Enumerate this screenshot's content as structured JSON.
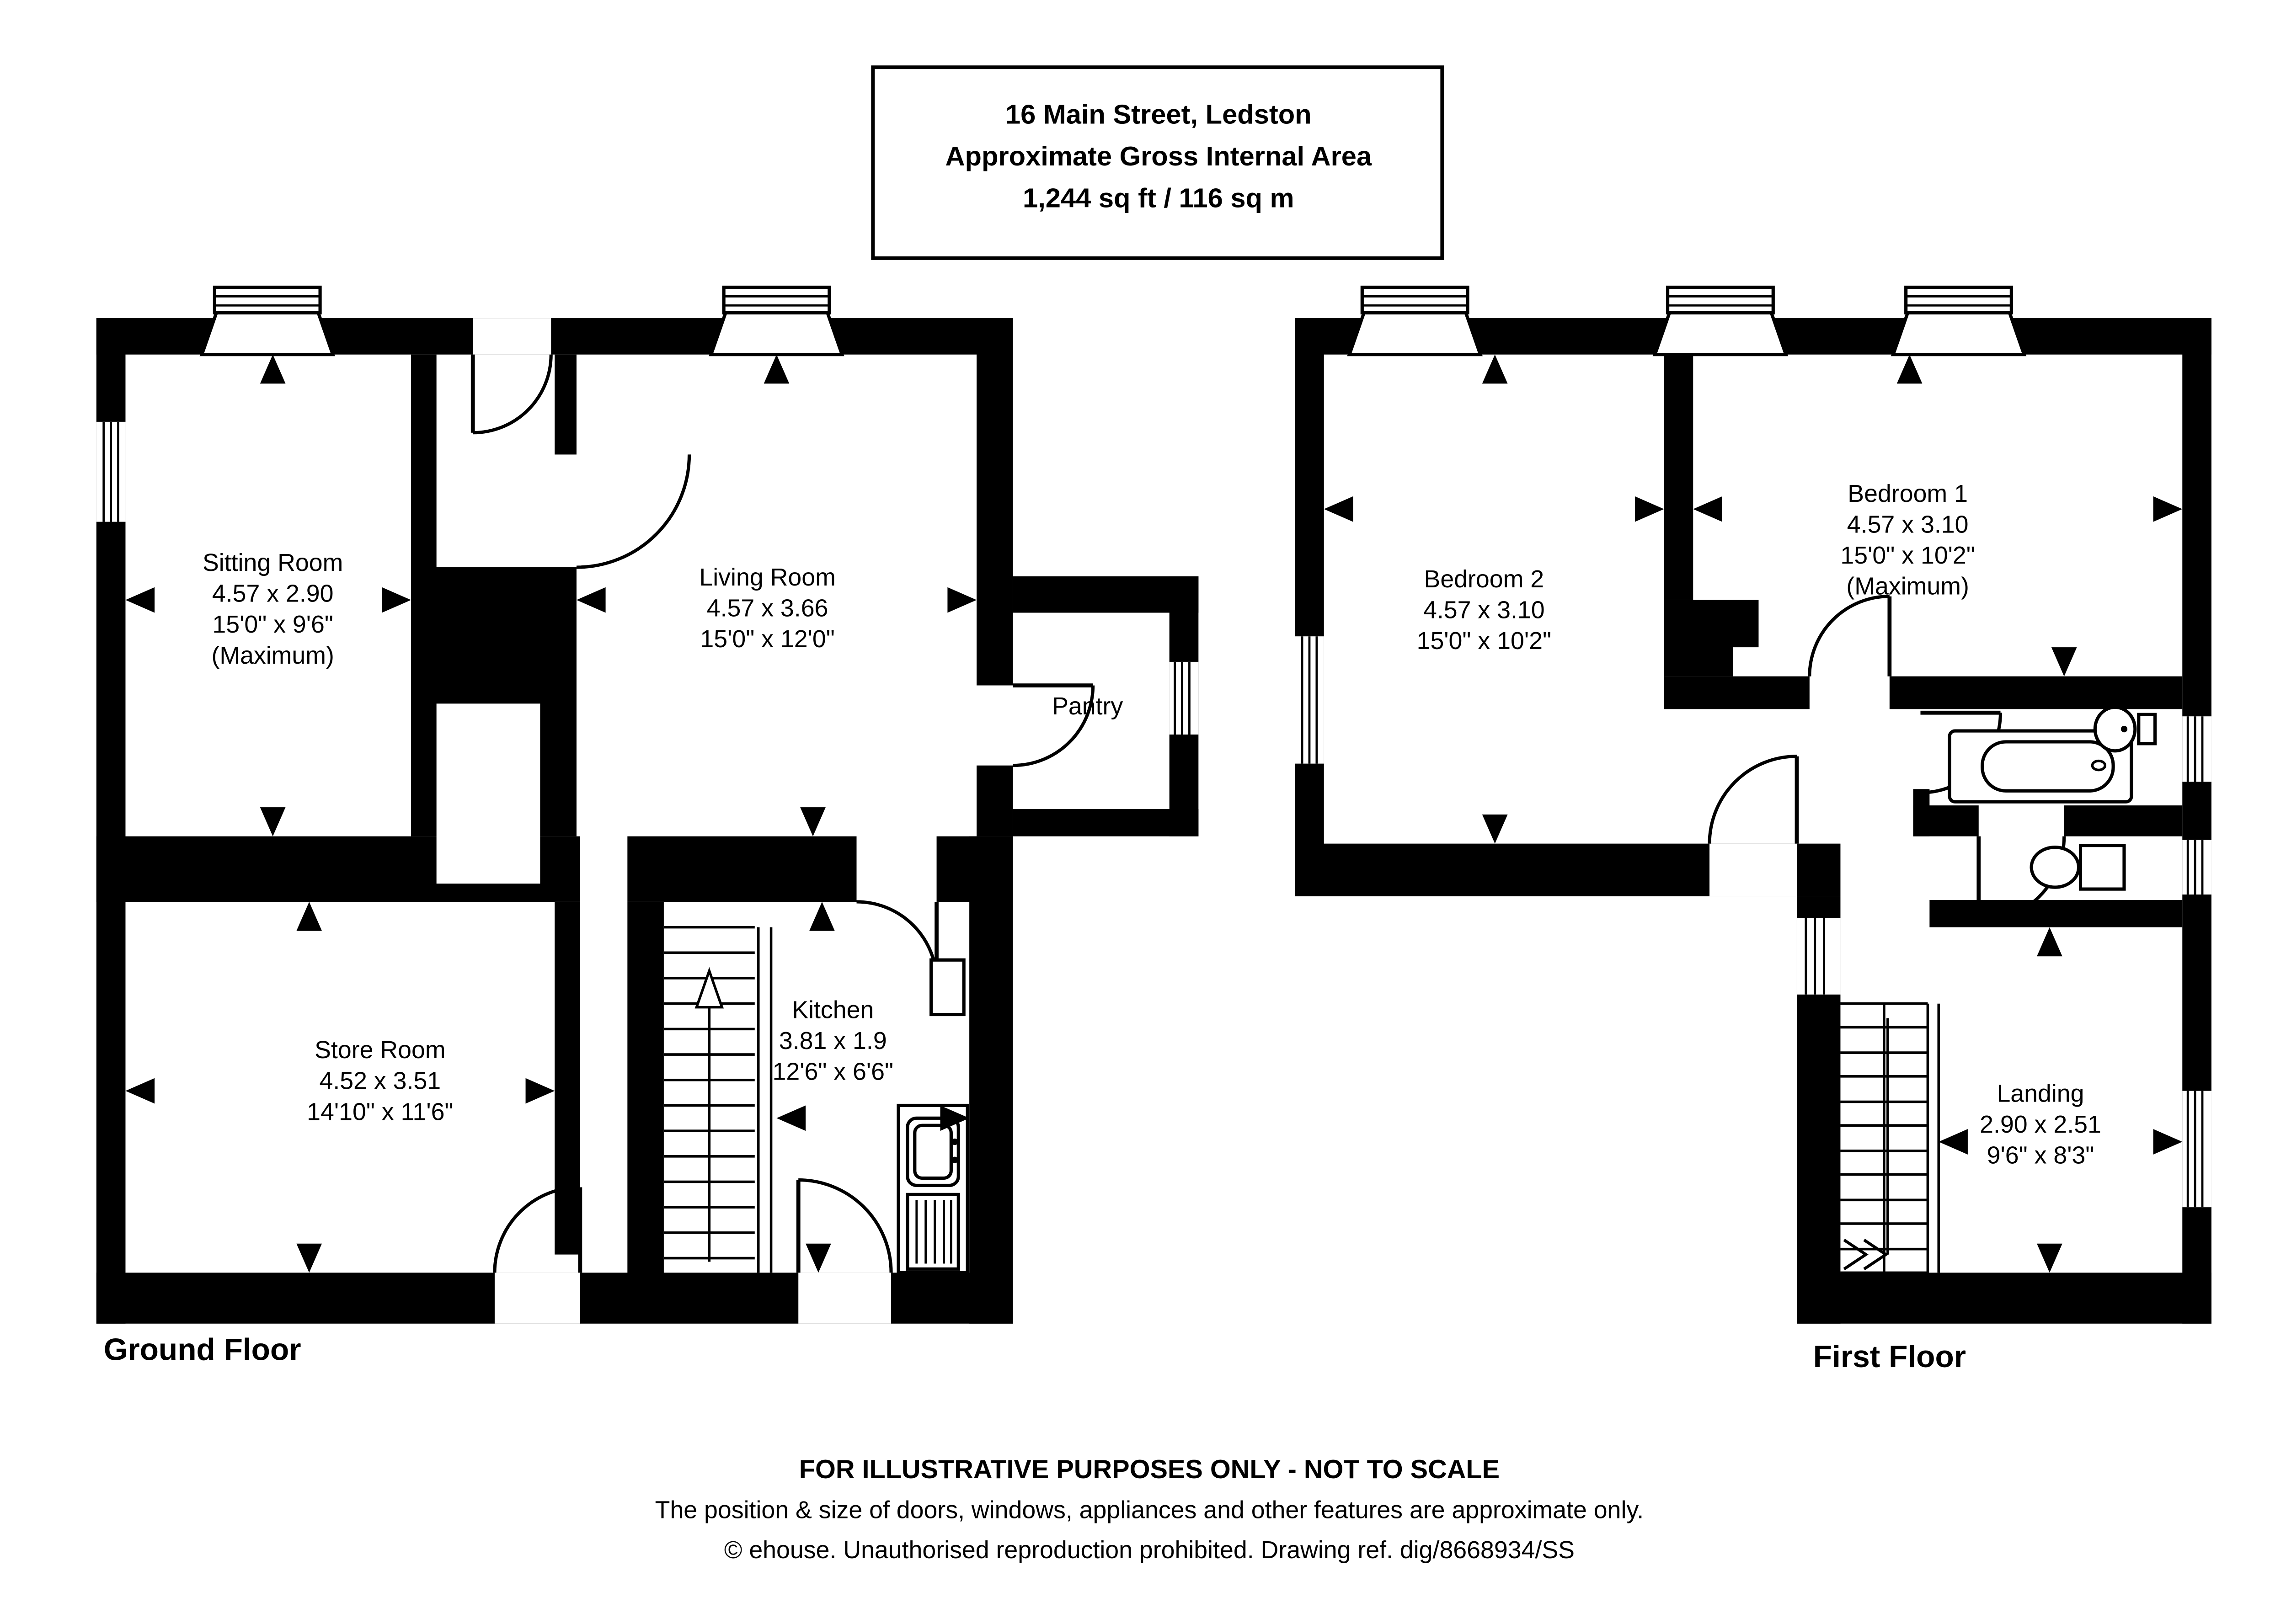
{
  "title_box": {
    "line1": "16 Main Street, Ledston",
    "line2": "Approximate Gross Internal Area",
    "line3": "1,244 sq ft / 116 sq m"
  },
  "ground": {
    "label": "Ground Floor",
    "rooms": [
      {
        "name": "Sitting Room",
        "metric": "4.57 x 2.90",
        "imperial": "15'0\" x 9'6\"",
        "note": "(Maximum)"
      },
      {
        "name": "Living Room",
        "metric": "4.57 x 3.66",
        "imperial": "15'0\" x 12'0\""
      },
      {
        "name": "Pantry"
      },
      {
        "name": "Store Room",
        "metric": "4.52 x 3.51",
        "imperial": "14'10\" x 11'6\""
      },
      {
        "name": "Kitchen",
        "metric": "3.81 x 1.9",
        "imperial": "12'6\" x 6'6\""
      }
    ]
  },
  "first": {
    "label": "First Floor",
    "rooms": [
      {
        "name": "Bedroom 1",
        "metric": "4.57 x 3.10",
        "imperial": "15'0\" x 10'2\"",
        "note": "(Maximum)"
      },
      {
        "name": "Bedroom 2",
        "metric": "4.57 x 3.10",
        "imperial": "15'0\" x 10'2\""
      },
      {
        "name": "Landing",
        "metric": "2.90 x 2.51",
        "imperial": "9'6\" x 8'3\""
      }
    ]
  },
  "footer": {
    "line1": "FOR ILLUSTRATIVE PURPOSES ONLY - NOT TO SCALE",
    "line2": "The position & size of doors, windows, appliances and other features are approximate only.",
    "line3": "© ehouse. Unauthorised reproduction prohibited. Drawing ref. dig/8668934/SS"
  }
}
